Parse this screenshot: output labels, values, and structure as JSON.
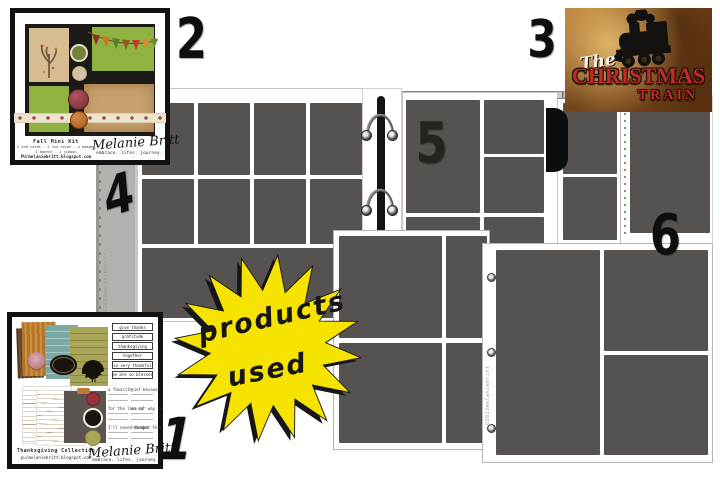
{
  "nums": {
    "n1": "1",
    "n2": "2",
    "n3": "3",
    "n4": "4",
    "n5": "5",
    "n6": "6"
  },
  "star": {
    "word1": "products",
    "word2": "used",
    "fill": "#f6e300"
  },
  "fall": {
    "title": "Fall Mini Kit",
    "detail1": "2 4x6 cards - 2 3x4 cards - 4 badges",
    "detail2": "1 banner - 1 ribbon",
    "url": "PU/melaniebritt.blogspot.com",
    "signature": "Melanie Britt",
    "tagline": "embrace. lifes. journey."
  },
  "tg": {
    "title": "Thanksgiving Collection",
    "url": "pu/melaniebritt.blogspot.com",
    "signature": "Melanie Britt",
    "tagline": "embrace. lifes. journey.",
    "banners": [
      "give thanks",
      "gratitude",
      "thanksgiving",
      "together",
      "so very thankful",
      "we are so blessed"
    ],
    "prompts_l": [
      "a favorite",
      "for the love of",
      "I'll never forget"
    ],
    "prompts_r": [
      "just because",
      "on our way to",
      "remember this."
    ]
  },
  "train": {
    "word_the": "The",
    "word_christmas": "Christmas",
    "word_train": "Train"
  },
  "wm": {
    "text": "©2013melaniebritt"
  },
  "colors": {
    "slot_gray": "#56524f",
    "album_gray": "#b3b1ae",
    "star_yellow": "#f6e300",
    "train_red": "#c42a27",
    "kit_green": "#90b241",
    "kit_tan": "#d8bc92",
    "kit_kraft": "#c8a26e"
  }
}
